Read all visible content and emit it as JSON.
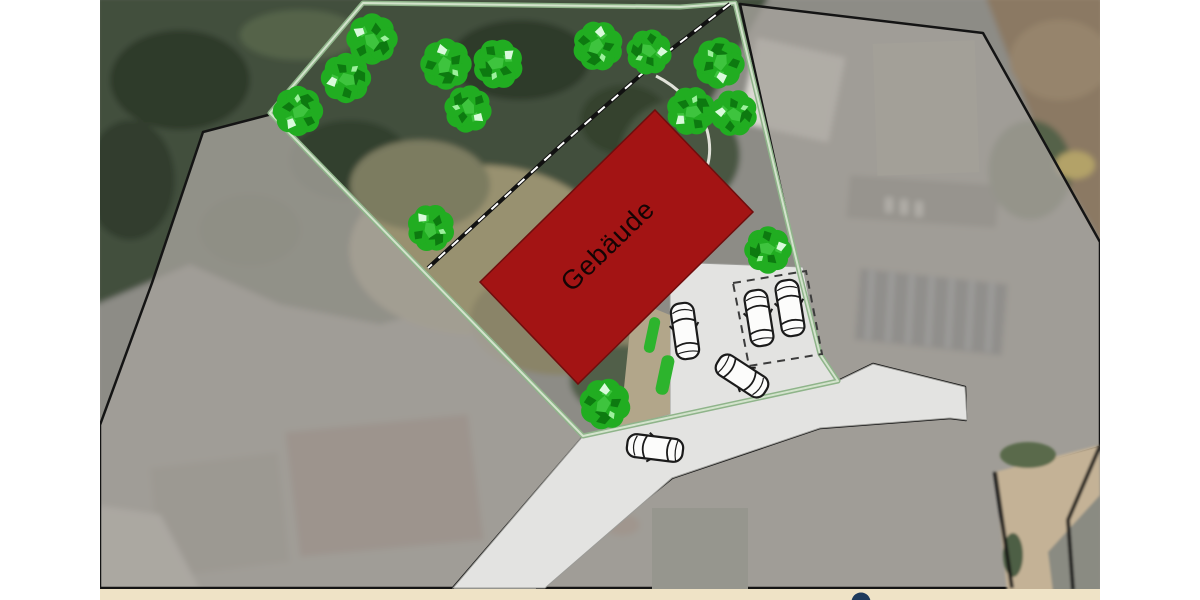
{
  "plan": {
    "building_label": "Gebäude",
    "colors": {
      "building_fill": "#a31414",
      "building_stroke": "#700d0d",
      "tree_green": "#21ad21",
      "tree_dark": "#0d7a10",
      "tree_mid": "#3ec43e",
      "tree_light": "#d9fadb",
      "boundary_green": "#8fb48a",
      "boundary_core": "#d3e3cc",
      "road_fill": "#e3e3e1",
      "driveway_tan": "#b2a68a",
      "hedge_green": "#2db42d",
      "overlay_gray": "rgba(165,161,155,0.8)",
      "footer_cream": "#efe3c6",
      "logo_navy": "#1e3a5c"
    },
    "counts": {
      "trees": 14,
      "cars": 5,
      "marked_parking_spaces": 2
    }
  }
}
